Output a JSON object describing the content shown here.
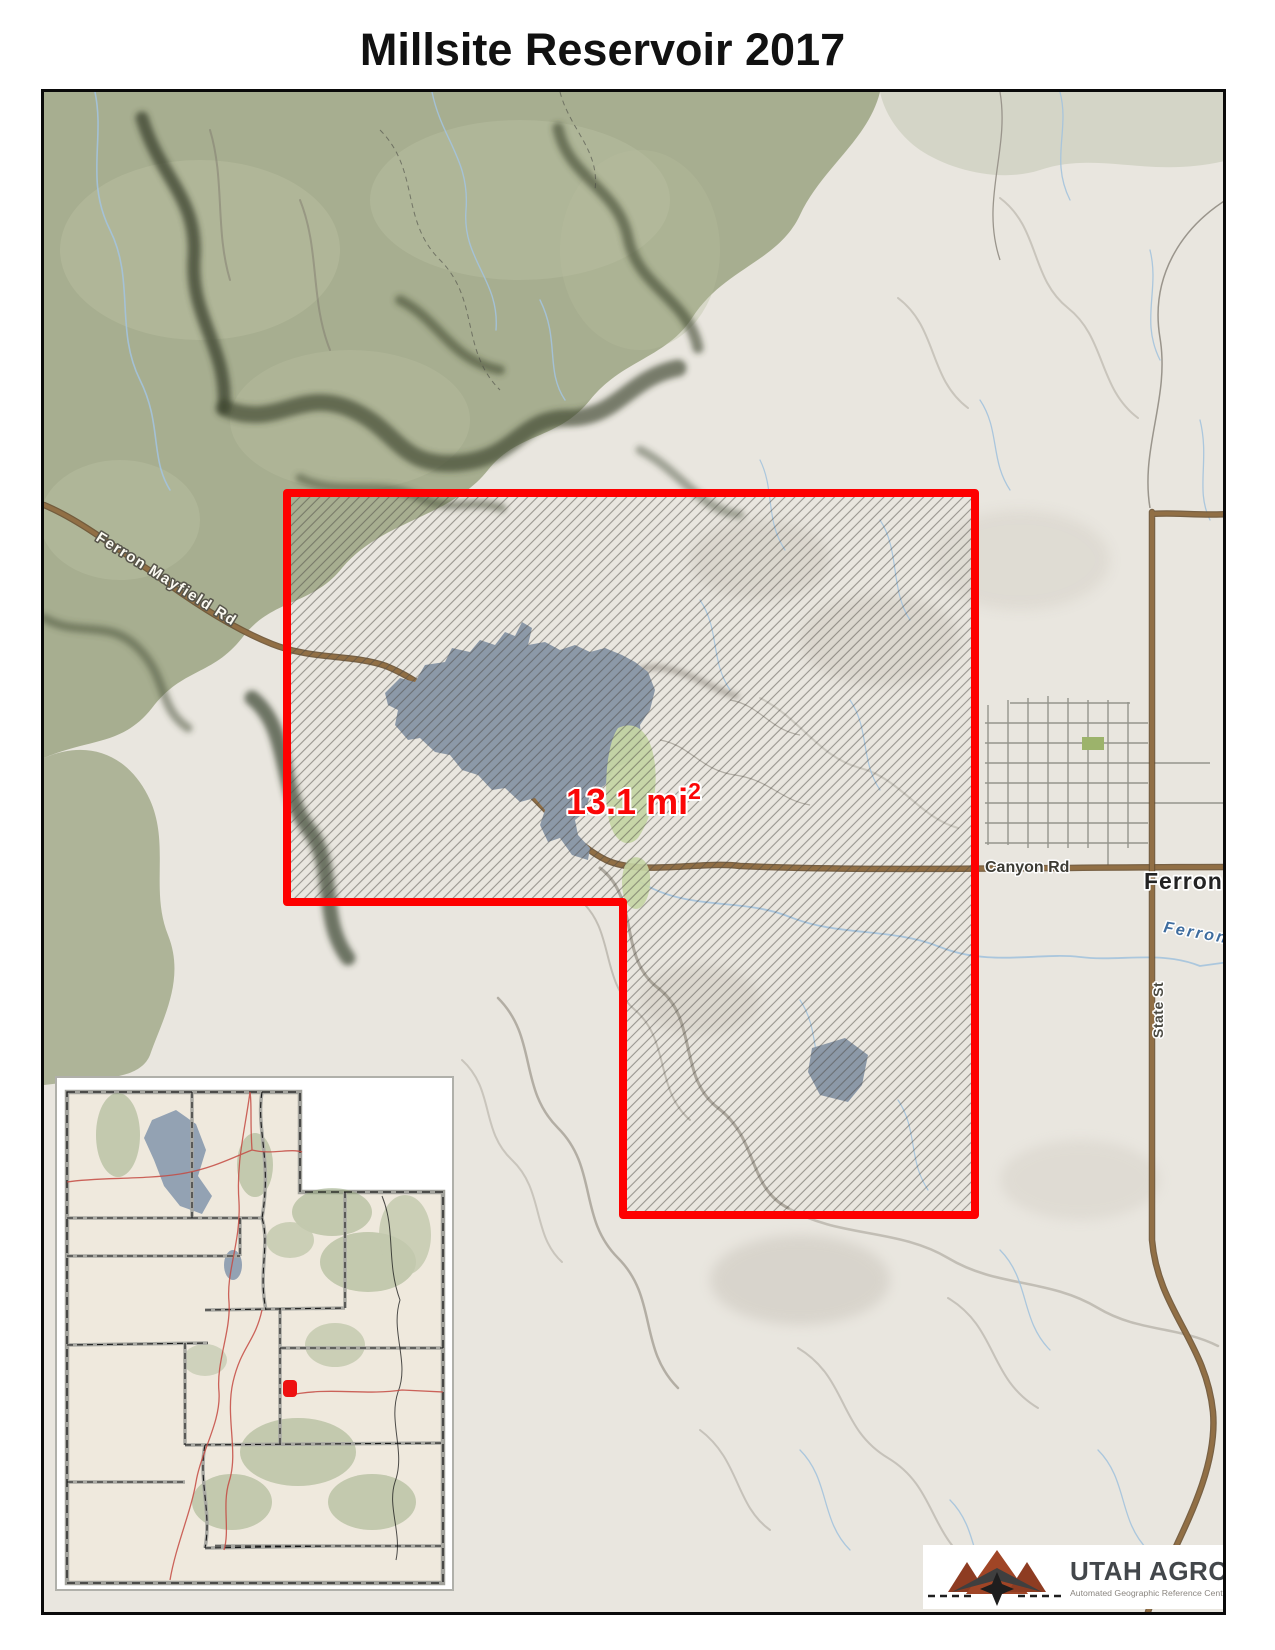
{
  "title": "Millsite Reservoir 2017",
  "map": {
    "area_label": {
      "text": "13.1 mi",
      "exponent": "2"
    },
    "labels": {
      "mayfield_road": "Ferron Mayfield Rd",
      "canyon_road": "Canyon Rd",
      "town": "Ferron",
      "creek": "Ferron",
      "street": "State St"
    },
    "colors": {
      "boundary": "#fe0000",
      "area_text": "#fb0606",
      "water": "#8c99a8",
      "road": "#916f45",
      "forest": "#a7ae90",
      "terrain_base": "#e9e6df",
      "creek_line": "#a4c3dd"
    }
  },
  "inset": {
    "marker_color": "#ee1111",
    "lake_color": "#93a2b3"
  },
  "logo": {
    "name": "UTAH AGRC",
    "subtitle": "Automated Geographic Reference Center"
  }
}
